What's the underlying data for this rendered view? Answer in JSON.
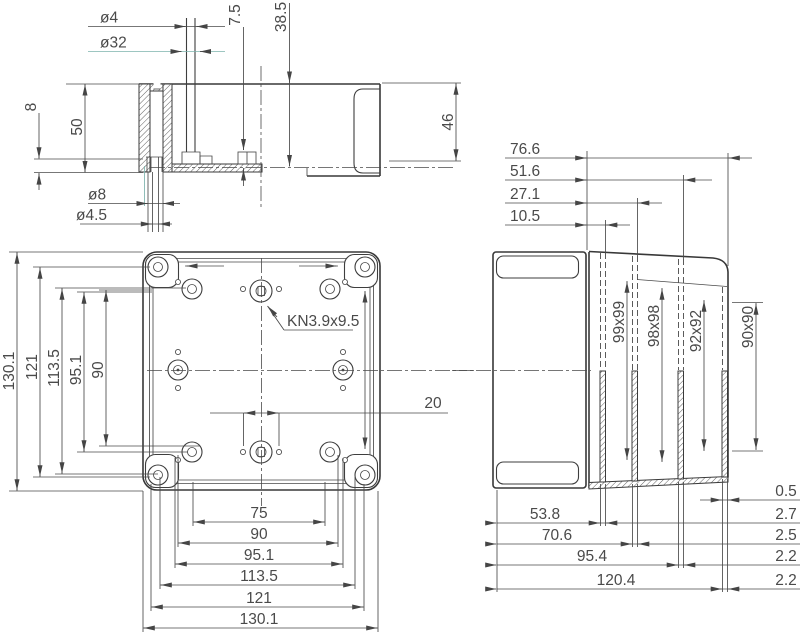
{
  "drawing": {
    "section_view": {
      "dia4": "ø4",
      "dia32": "ø32",
      "depth7_5": "7.5",
      "depth38_5": "38.5",
      "left8": "8",
      "left50": "50",
      "right46": "46",
      "dia8": "ø8",
      "dia4_5": "ø4.5"
    },
    "top_view": {
      "callout": "KN3.9x9.5",
      "dim20": "20",
      "left": [
        "130.1",
        "121",
        "113.5",
        "95.1",
        "90"
      ],
      "bottom": [
        "75",
        "90",
        "95.1",
        "113.5",
        "121",
        "130.1"
      ]
    },
    "side_view": {
      "offsets": [
        "76.6",
        "51.6",
        "27.1",
        "10.5"
      ],
      "inner_sizes": [
        "99x99",
        "98x98",
        "92x92",
        "90x90"
      ],
      "widths": [
        "53.8",
        "70.6",
        "95.4",
        "120.4"
      ],
      "thicknesses": [
        "0.5",
        "2.7",
        "2.5",
        "2.2",
        "2.2"
      ]
    }
  },
  "colors": {
    "line": "#3a3a3a",
    "dim": "#4a4a4a",
    "accent": "#7db3ad",
    "background": "#ffffff"
  }
}
